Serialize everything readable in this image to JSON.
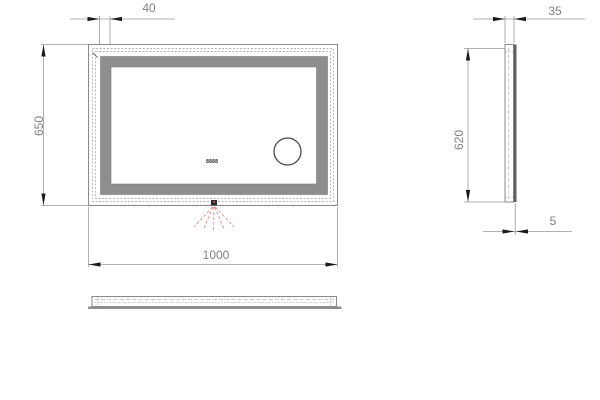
{
  "views": {
    "front": {
      "dim_frame_width": "40",
      "dim_height": "650",
      "dim_width": "1000",
      "clock_display": "8888"
    },
    "side": {
      "dim_depth": "35",
      "dim_led_height": "620",
      "dim_glass_thickness": "5"
    }
  },
  "colors": {
    "edge_line": "#8a8a8a",
    "frame_fill": "#8e8e8e",
    "mirror_fill": "#ffffff",
    "led_band": "#b3b3b3",
    "dimension_line": "#9a9a9a",
    "dimension_text": "#7f7f7f",
    "arrow": "#1a1a1a",
    "glass_edge": "#5f5f5f",
    "sensor_body": "#2e2e2e",
    "sensor_rays": "#e08a8a"
  }
}
